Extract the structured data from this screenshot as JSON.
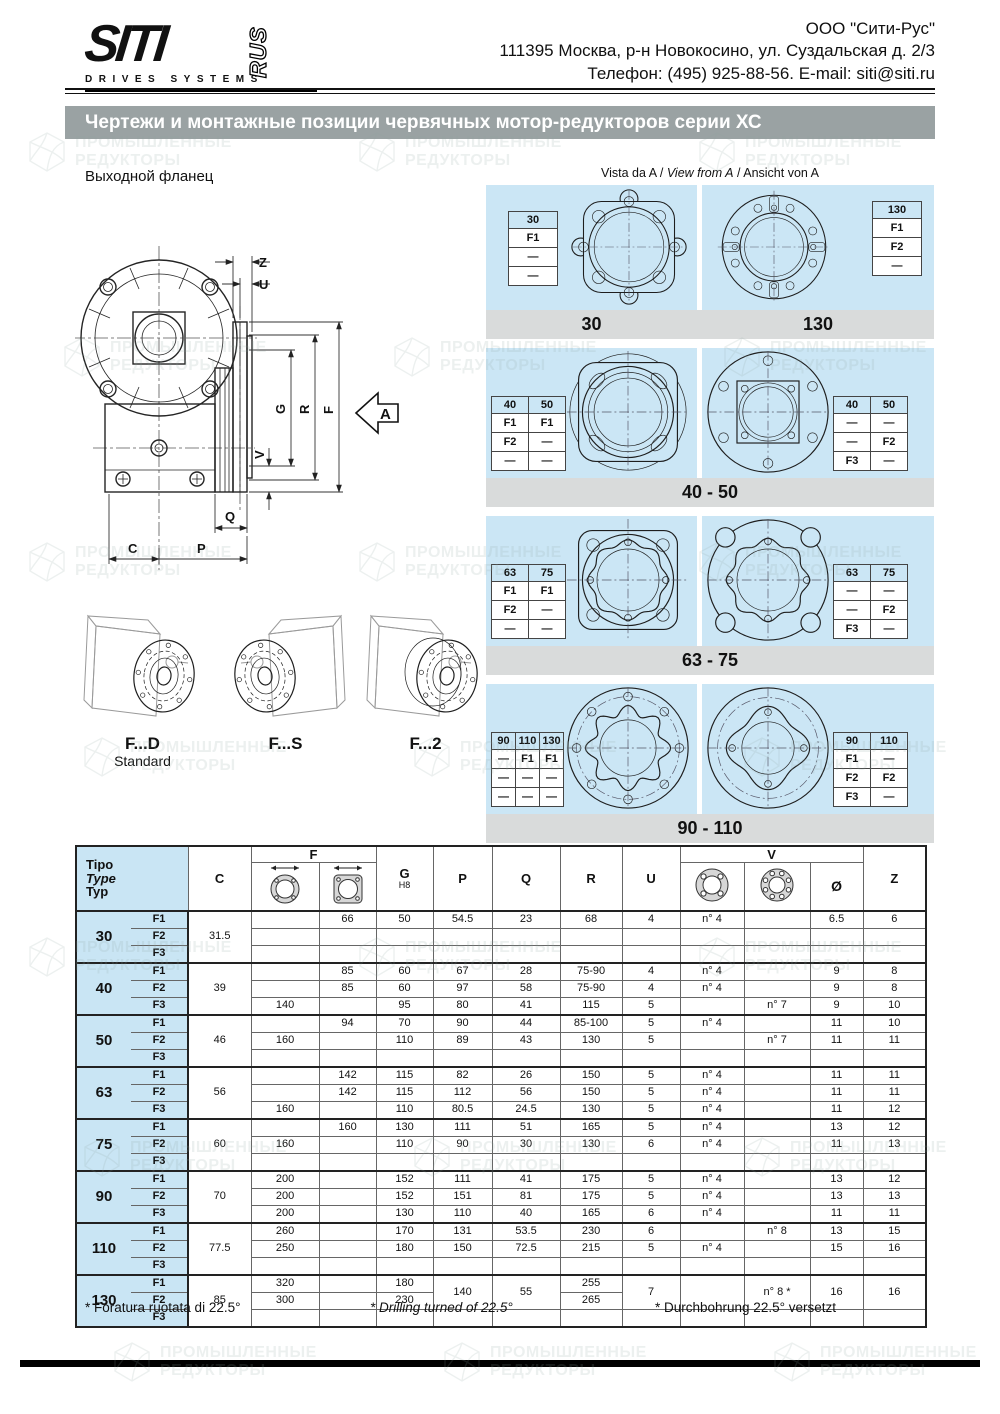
{
  "header": {
    "logo": {
      "siti": "SITI",
      "rus": "RUS",
      "subtitle": "DRIVES SYSTEMS"
    },
    "company": "ООО \"Сити-Рус\"",
    "address": "111395 Москва, р-н Новокосино, ул. Суздальская д. 2/3",
    "contacts": "Телефон: (495) 925-88-56. E-mail: siti@siti.ru"
  },
  "title": "Чертежи и монтажные позиции червячных мотор-редукторов серии ХС",
  "drawing": {
    "label": "Выходной фланец",
    "dims": {
      "z": "Z",
      "u": "U",
      "g": "G",
      "r": "R",
      "f": "F",
      "v": "V",
      "q": "Q",
      "c": "C",
      "p": "P",
      "a": "A"
    }
  },
  "view": {
    "seg1": "Vista da A / ",
    "seg2": "View from A",
    "seg3": " / Ansicht von A",
    "blocks": [
      {
        "captions": [
          "30",
          "130"
        ],
        "panels": [
          {
            "drawing": "sq30",
            "side": "left",
            "table": {
              "headers": [
                "30"
              ],
              "rows": [
                [
                  "F1"
                ],
                [
                  "—"
                ],
                [
                  "—"
                ]
              ]
            }
          },
          {
            "drawing": "c130",
            "side": "right",
            "table": {
              "headers": [
                "130"
              ],
              "rows": [
                [
                  "F1"
                ],
                [
                  "F2"
                ],
                [
                  "—"
                ]
              ]
            }
          }
        ]
      },
      {
        "captions": [
          "40 - 50"
        ],
        "panels": [
          {
            "drawing": "sq4050",
            "side": "left",
            "table": {
              "headers": [
                "40",
                "50"
              ],
              "rows": [
                [
                  "F1",
                  "F1"
                ],
                [
                  "F2",
                  "—"
                ],
                [
                  "—",
                  "—"
                ]
              ]
            }
          },
          {
            "drawing": "c4050",
            "side": "right",
            "table": {
              "headers": [
                "40",
                "50"
              ],
              "rows": [
                [
                  "—",
                  "—"
                ],
                [
                  "—",
                  "F2"
                ],
                [
                  "F3",
                  "—"
                ]
              ]
            }
          }
        ]
      },
      {
        "captions": [
          "63 - 75"
        ],
        "panels": [
          {
            "drawing": "sq6375",
            "side": "left",
            "table": {
              "headers": [
                "63",
                "75"
              ],
              "rows": [
                [
                  "F1",
                  "F1"
                ],
                [
                  "F2",
                  "—"
                ],
                [
                  "—",
                  "—"
                ]
              ]
            }
          },
          {
            "drawing": "c6375",
            "side": "right",
            "table": {
              "headers": [
                "63",
                "75"
              ],
              "rows": [
                [
                  "—",
                  "—"
                ],
                [
                  "—",
                  "F2"
                ],
                [
                  "F3",
                  "—"
                ]
              ]
            }
          }
        ]
      },
      {
        "captions": [
          "90 - 110"
        ],
        "panels": [
          {
            "drawing": "c90110a",
            "side": "left",
            "table": {
              "headers": [
                "90",
                "110",
                "130"
              ],
              "rows": [
                [
                  "—",
                  "F1",
                  "F1"
                ],
                [
                  "—",
                  "—",
                  "—"
                ],
                [
                  "—",
                  "—",
                  "—"
                ]
              ]
            }
          },
          {
            "drawing": "c90110b",
            "side": "right",
            "table": {
              "headers": [
                "90",
                "110"
              ],
              "rows": [
                [
                  "F1",
                  "—"
                ],
                [
                  "F2",
                  "F2"
                ],
                [
                  "F3",
                  "—"
                ]
              ]
            }
          }
        ]
      }
    ]
  },
  "variants": [
    {
      "label": "F...D",
      "sub": "Standard"
    },
    {
      "label": "F...S",
      "sub": ""
    },
    {
      "label": "F...2",
      "sub": ""
    }
  ],
  "table": {
    "header": {
      "tipo": [
        "Tipo",
        "Type",
        "Typ"
      ],
      "c": "C",
      "f": "F",
      "g": "G",
      "h8": "H8",
      "p": "P",
      "q": "Q",
      "r": "R",
      "u": "U",
      "v": "V",
      "dia": "Ø",
      "z": "Z"
    },
    "groups": [
      {
        "size": "30",
        "c": "31.5",
        "rows": [
          {
            "f": "F1",
            "f1": "",
            "f2": "66",
            "g": "50",
            "p": "54.5",
            "q": "23",
            "r": "68",
            "u": "4",
            "v1": "n° 4",
            "v2": "",
            "d": "6.5",
            "z": "6"
          },
          {
            "f": "F2"
          },
          {
            "f": "F3"
          }
        ]
      },
      {
        "size": "40",
        "c": "39",
        "rows": [
          {
            "f": "F1",
            "f2": "85",
            "g": "60",
            "p": "67",
            "q": "28",
            "r": "75-90",
            "u": "4",
            "v1": "n° 4",
            "d": "9",
            "z": "8"
          },
          {
            "f": "F2",
            "f2": "85",
            "g": "60",
            "p": "97",
            "q": "58",
            "r": "75-90",
            "u": "4",
            "v1": "n° 4",
            "d": "9",
            "z": "8"
          },
          {
            "f": "F3",
            "f1": "140",
            "g": "95",
            "p": "80",
            "q": "41",
            "r": "115",
            "u": "5",
            "v2": "n° 7",
            "d": "9",
            "z": "10"
          }
        ]
      },
      {
        "size": "50",
        "c": "46",
        "rows": [
          {
            "f": "F1",
            "f2": "94",
            "g": "70",
            "p": "90",
            "q": "44",
            "r": "85-100",
            "u": "5",
            "v1": "n° 4",
            "d": "11",
            "z": "10"
          },
          {
            "f": "F2",
            "f1": "160",
            "g": "110",
            "p": "89",
            "q": "43",
            "r": "130",
            "u": "5",
            "v2": "n° 7",
            "d": "11",
            "z": "11"
          },
          {
            "f": "F3"
          }
        ]
      },
      {
        "size": "63",
        "c": "56",
        "rows": [
          {
            "f": "F1",
            "f2": "142",
            "g": "115",
            "p": "82",
            "q": "26",
            "r": "150",
            "u": "5",
            "v1": "n° 4",
            "d": "11",
            "z": "11"
          },
          {
            "f": "F2",
            "f2": "142",
            "g": "115",
            "p": "112",
            "q": "56",
            "r": "150",
            "u": "5",
            "v1": "n° 4",
            "d": "11",
            "z": "11"
          },
          {
            "f": "F3",
            "f1": "160",
            "g": "110",
            "p": "80.5",
            "q": "24.5",
            "r": "130",
            "u": "5",
            "v1": "n° 4",
            "d": "11",
            "z": "12"
          }
        ]
      },
      {
        "size": "75",
        "c": "60",
        "rows": [
          {
            "f": "F1",
            "f2": "160",
            "g": "130",
            "p": "111",
            "q": "51",
            "r": "165",
            "u": "5",
            "v1": "n° 4",
            "d": "13",
            "z": "12"
          },
          {
            "f": "F2",
            "f1": "160",
            "g": "110",
            "p": "90",
            "q": "30",
            "r": "130",
            "u": "6",
            "v1": "n° 4",
            "d": "11",
            "z": "13"
          },
          {
            "f": "F3"
          }
        ]
      },
      {
        "size": "90",
        "c": "70",
        "rows": [
          {
            "f": "F1",
            "f1": "200",
            "g": "152",
            "p": "111",
            "q": "41",
            "r": "175",
            "u": "5",
            "v1": "n° 4",
            "d": "13",
            "z": "12"
          },
          {
            "f": "F2",
            "f1": "200",
            "g": "152",
            "p": "151",
            "q": "81",
            "r": "175",
            "u": "5",
            "v1": "n° 4",
            "d": "13",
            "z": "13"
          },
          {
            "f": "F3",
            "f1": "200",
            "g": "130",
            "p": "110",
            "q": "40",
            "r": "165",
            "u": "6",
            "v1": "n° 4",
            "d": "11",
            "z": "11"
          }
        ]
      },
      {
        "size": "110",
        "c": "77.5",
        "rows": [
          {
            "f": "F1",
            "f1": "260",
            "g": "170",
            "p": "131",
            "q": "53.5",
            "r": "230",
            "u": "6",
            "v2": "n° 8",
            "d": "13",
            "z": "15"
          },
          {
            "f": "F2",
            "f1": "250",
            "g": "180",
            "p": "150",
            "q": "72.5",
            "r": "215",
            "u": "5",
            "v1": "n° 4",
            "d": "15",
            "z": "16"
          },
          {
            "f": "F3"
          }
        ]
      },
      {
        "size": "130",
        "c": "85",
        "merged": true,
        "rows": [
          {
            "f": "F1",
            "f1": "320",
            "g": "180",
            "r": "255"
          },
          {
            "f": "F2",
            "f1": "300",
            "g": "230",
            "r": "265"
          },
          {
            "f": "F3"
          }
        ],
        "shared": {
          "p": "140",
          "q": "55",
          "u": "7",
          "v2": "n° 8 *",
          "d": "16",
          "z": "16"
        }
      }
    ]
  },
  "footnotes": [
    "* Foratura ruotata di 22.5°",
    "* Drilling turned of 22.5°",
    "* Durchbohrung 22.5° versetzt"
  ],
  "watermark": {
    "line1": "ПРОМЫШЛЕННЫЕ",
    "line2": "РЕДУКТОРЫ"
  }
}
